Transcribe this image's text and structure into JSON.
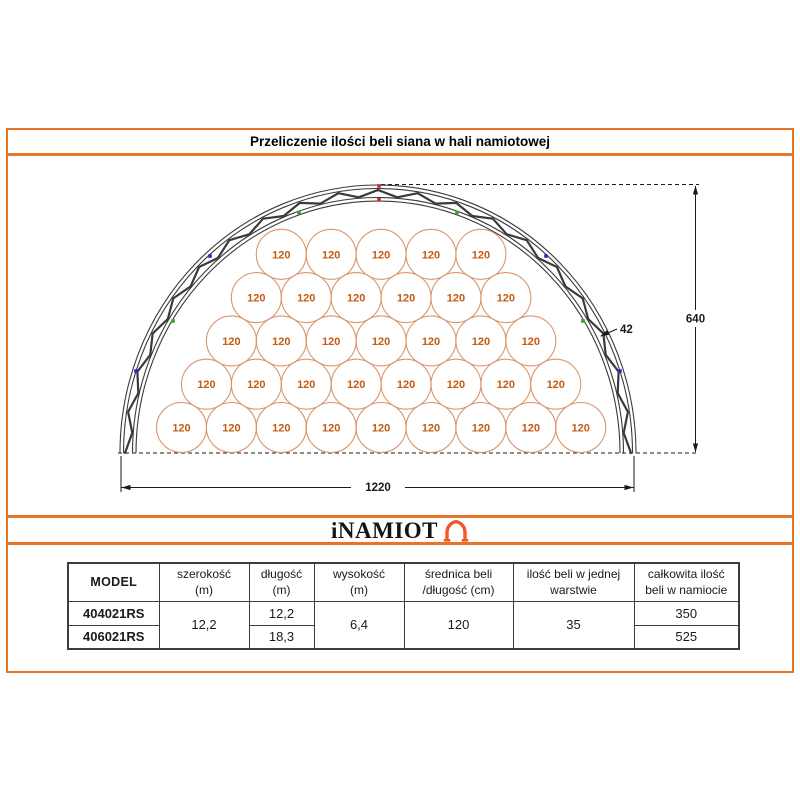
{
  "title": "Przeliczenie ilości beli siana w hali namiotowej",
  "logo": {
    "text": "iNAMIOT"
  },
  "diagram": {
    "bale_diameter_label": "120",
    "rows_bottom_to_top": [
      9,
      8,
      7,
      6,
      5
    ],
    "dim_width_label": "1220",
    "dim_height_label": "640",
    "dim_truss_label": "42",
    "colors": {
      "accent_orange": "#E8742C",
      "circle_stroke": "#D9966B",
      "circle_text": "#C55A11",
      "truss": "#3A3A3A",
      "dim": "#1A1A1A",
      "marker_red": "#CC2A2A",
      "marker_green": "#2FA52F",
      "marker_blue": "#2B2BC4"
    }
  },
  "table": {
    "headers": [
      {
        "l1": "MODEL",
        "l2": ""
      },
      {
        "l1": "szerokość",
        "l2": "(m)"
      },
      {
        "l1": "długość",
        "l2": "(m)"
      },
      {
        "l1": "wysokość",
        "l2": "(m)"
      },
      {
        "l1": "średnica beli",
        "l2": "/długość (cm)"
      },
      {
        "l1": "ilość beli w jednej",
        "l2": "warstwie"
      },
      {
        "l1": "całkowita ilość",
        "l2": "beli w namiocie"
      }
    ],
    "models": [
      "404021RS",
      "406021RS"
    ],
    "szerokosc_m": "12,2",
    "dlugosc_m": [
      "12,2",
      "18,3"
    ],
    "wysokosc_m": "6,4",
    "srednica_cm": "120",
    "ilosc_beli_warstwa": "35",
    "calkowita_ilosc": [
      "350",
      "525"
    ]
  }
}
